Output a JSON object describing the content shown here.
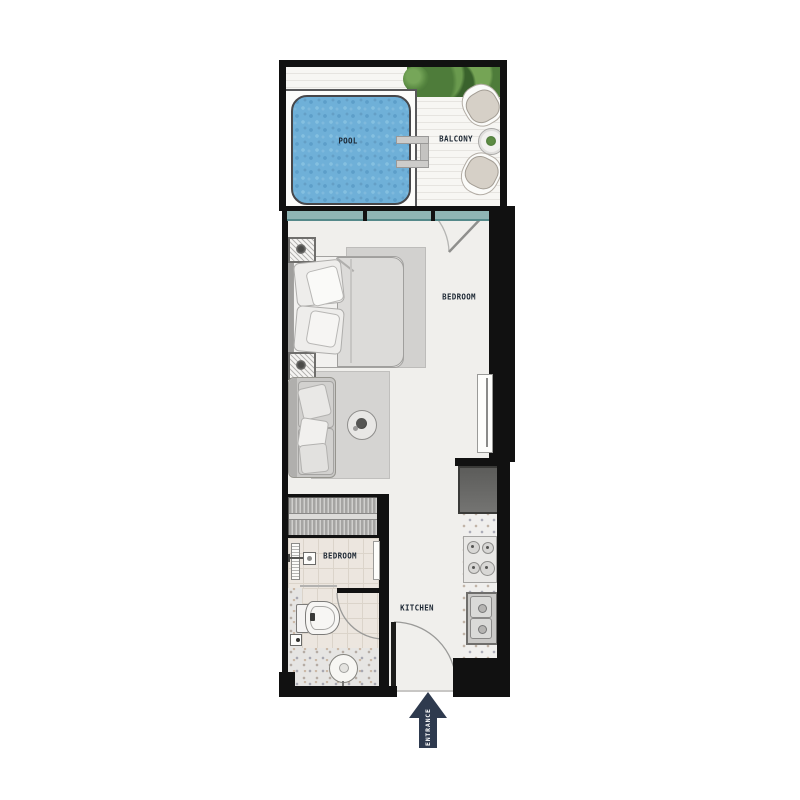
{
  "labels": {
    "pool": "POOL",
    "balcony": "BALCONY",
    "bedroom": "BEDROOM",
    "bathroom": "BEDROOM",
    "kitchen": "KITCHEN",
    "entrance": "ENTRANCE"
  },
  "colors": {
    "wall": "#111111",
    "pool_water": "#6fb0d8",
    "window_glass": "#8fb5b4",
    "deck": "#f7f6f3",
    "floor": "#f0efec",
    "bathroom_tile": "#ece6df",
    "entrance_arrow": "#2e3a4e",
    "label_text": "#1c2733",
    "plant_green": "#4e7c3a",
    "rug_gray": "#d5d4d2",
    "fridge_gray": "#636361"
  }
}
